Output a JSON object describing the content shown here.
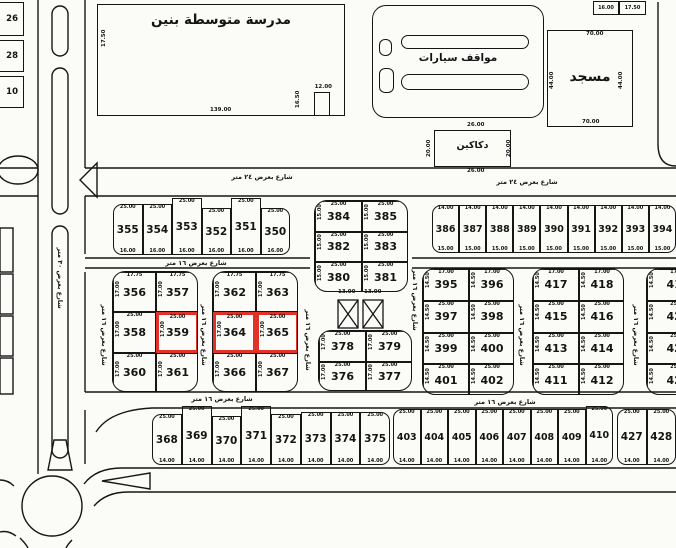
{
  "map": {
    "landmarks": {
      "school": {
        "label": "مدرسة متوسطة بنين",
        "dim_left": "17.50",
        "dim_bottom": "139.00",
        "notch_dim_top": "12.00",
        "notch_dim_side": "16.50"
      },
      "parking": {
        "label": "مواقف سيارات"
      },
      "mosque": {
        "label": "مسجد",
        "dim_top": "70.00",
        "dim_bottom": "70.00",
        "dim_left": "44.00",
        "dim_right": "44.00"
      },
      "shops": {
        "label": "دكاكين",
        "dim_top": "26.00",
        "dim_bottom": "26.00",
        "dim_left": "20.00",
        "dim_right": "20.00"
      },
      "utility": {
        "dim_a": "13.00",
        "dim_b": "13.00"
      }
    },
    "corner_cells": [
      "16.00",
      "17.50"
    ],
    "edge_plots": [
      "26",
      "28",
      "10"
    ],
    "street_labels": {
      "w24": "شارع بعرض ٢٤ متر",
      "w16": "شارع بعرض ١٦ متر",
      "w30": "شارع بعرض ٣٠ متر"
    },
    "highlight_color": "#e03228",
    "highlighted_plots": [
      "359",
      "364",
      "365"
    ],
    "blocks": {
      "A": {
        "plots": [
          "355",
          "354",
          "353",
          "352",
          "351",
          "350"
        ],
        "dims": {
          "top": "25.00",
          "bottom": "16.00"
        }
      },
      "B": {
        "rows": [
          [
            "384",
            "385"
          ],
          [
            "382",
            "383"
          ],
          [
            "380",
            "381"
          ]
        ],
        "dims": {
          "top": "25.00",
          "inner": "25.00",
          "side": "15.00"
        }
      },
      "C": {
        "plots": [
          "386",
          "387",
          "388",
          "389",
          "390",
          "391",
          "392",
          "393",
          "394"
        ],
        "dims": {
          "top": "14.00",
          "bottom": "15.00"
        }
      },
      "D": {
        "rows": [
          [
            "356",
            "357"
          ],
          [
            "358",
            "359"
          ],
          [
            "360",
            "361"
          ]
        ],
        "dims": {
          "top": "17.75",
          "inner": "25.00",
          "side": "17.00"
        }
      },
      "E": {
        "rows": [
          [
            "362",
            "363"
          ],
          [
            "364",
            "365"
          ],
          [
            "366",
            "367"
          ]
        ],
        "dims": {
          "top": "17.75",
          "inner": "25.00",
          "side": "17.00"
        }
      },
      "F": {
        "rows": [
          [
            "378",
            "379"
          ],
          [
            "376",
            "377"
          ]
        ],
        "dims": {
          "top": "25.00",
          "inner": "25.00",
          "side": "17.00"
        }
      },
      "G": {
        "rows": [
          [
            "395",
            "396"
          ],
          [
            "397",
            "398"
          ],
          [
            "399",
            "400"
          ],
          [
            "401",
            "402"
          ]
        ],
        "dims": {
          "top": "17.00",
          "inner": "25.00",
          "side": "14.50"
        }
      },
      "H": {
        "rows": [
          [
            "417",
            "418"
          ],
          [
            "415",
            "416"
          ],
          [
            "413",
            "414"
          ],
          [
            "411",
            "412"
          ]
        ],
        "dims": {
          "top": "17.00",
          "inner": "25.00",
          "side": "14.50"
        }
      },
      "I": {
        "rows": [
          [
            "419"
          ],
          [
            "421"
          ],
          [
            "423"
          ],
          [
            "425"
          ]
        ],
        "dims": {
          "top": "17.00",
          "inner": "25.00",
          "side": "14.50"
        }
      },
      "J": {
        "plots": [
          "368",
          "369",
          "370",
          "371",
          "372",
          "373",
          "374",
          "375"
        ],
        "dims": {
          "top": "25.00",
          "bottom": "14.00"
        }
      },
      "K": {
        "plots": [
          "403",
          "404",
          "405",
          "406",
          "407",
          "408",
          "409",
          "410"
        ],
        "dims": {
          "top": "25.00",
          "bottom": "14.00"
        }
      },
      "L": {
        "plots": [
          "427",
          "428"
        ],
        "dims": {
          "top": "25.00",
          "bottom": "14.00"
        }
      }
    }
  }
}
